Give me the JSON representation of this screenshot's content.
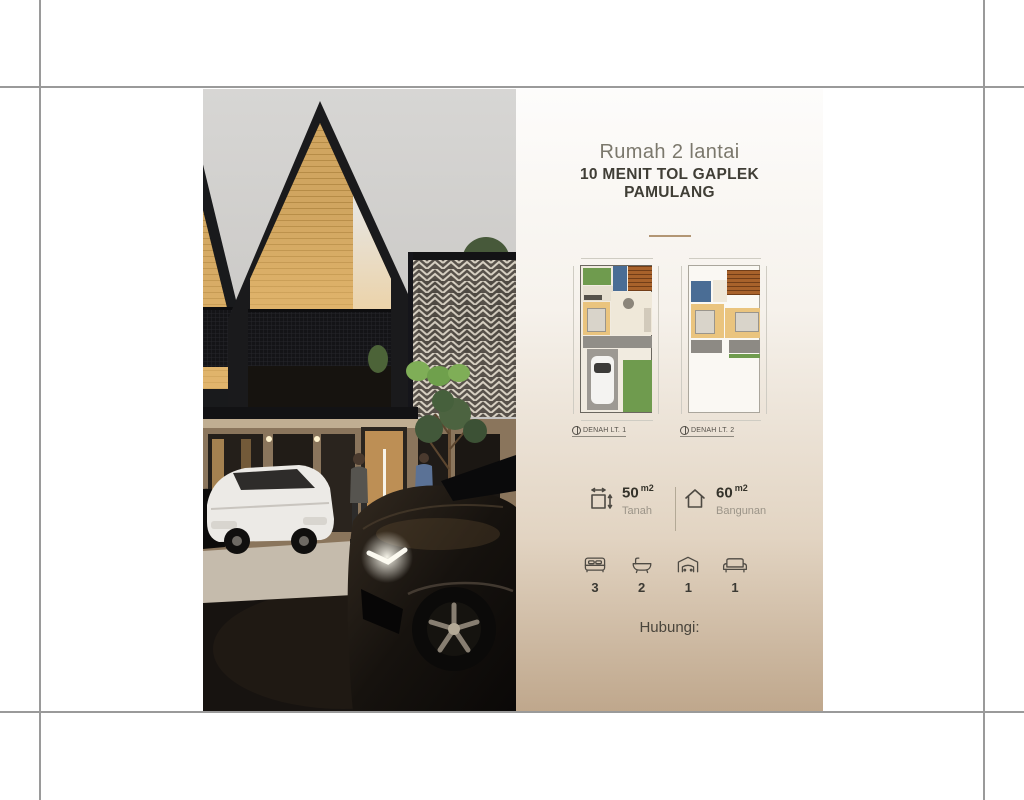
{
  "flyer": {
    "title": "Rumah 2 lantai",
    "subtitle_line1": "10 MENIT TOL GAPLEK",
    "subtitle_line2": "PAMULANG",
    "floor_plans": [
      {
        "label": "DENAH LT. 1"
      },
      {
        "label": "DENAH LT. 2"
      }
    ],
    "specs": [
      {
        "icon": "land-area-icon",
        "value": "50",
        "unit": "m2",
        "label": "Tanah"
      },
      {
        "icon": "building-area-icon",
        "value": "60",
        "unit": "m2",
        "label": "Bangunan"
      }
    ],
    "amenities": [
      {
        "icon": "bed-icon",
        "count": "3"
      },
      {
        "icon": "bathtub-icon",
        "count": "2"
      },
      {
        "icon": "garage-icon",
        "count": "1"
      },
      {
        "icon": "sofa-icon",
        "count": "1"
      }
    ],
    "contact_label": "Hubungi:"
  },
  "colors": {
    "guide_line": "#9a9a9a",
    "accent_divider": "#b29674",
    "panel_gradient_top": "#fdfcfb",
    "panel_gradient_bottom": "#bfa78c",
    "title_light": "#7b786c",
    "title_dark": "#403e36",
    "plan_garden": "#6f9b4e",
    "plan_bathroom": "#4a6d95",
    "plan_bedroom": "#eac47e",
    "plan_stairs": "#a8622b"
  }
}
